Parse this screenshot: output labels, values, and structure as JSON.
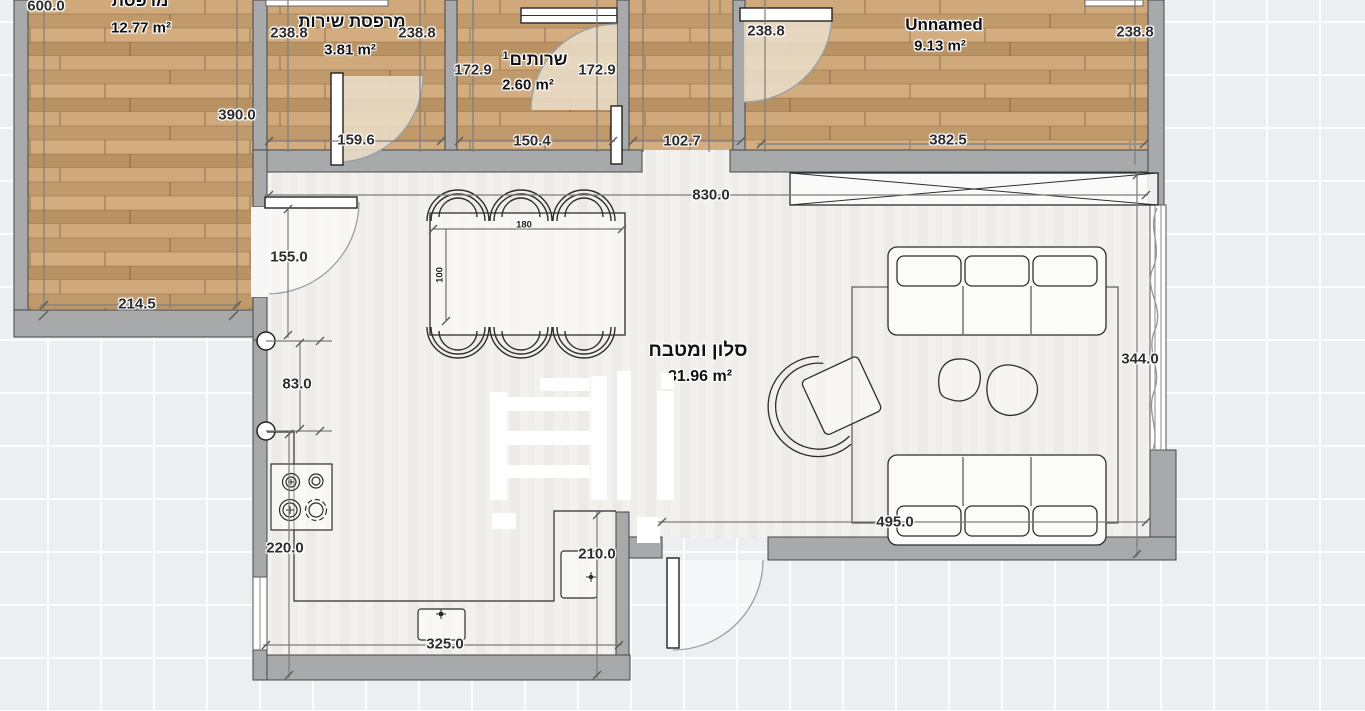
{
  "app": {
    "type": "floor-plan-editor-canvas"
  },
  "rooms": {
    "balcony": {
      "name": "מרפסת",
      "area": "12.77 m²"
    },
    "service_balcony": {
      "name": "מרפסת שירות",
      "area": "3.81 m²"
    },
    "bathroom": {
      "name": "שרותים",
      "index": "1",
      "area": "2.60 m²"
    },
    "unnamed": {
      "name": "Unnamed",
      "area": "9.13 m²"
    },
    "living_kitchen": {
      "name": "סלון ומטבח",
      "area": "31.96 m²"
    }
  },
  "dimensions": {
    "balcony_width_top": "600.0",
    "balcony_height": "390.0",
    "balcony_width_bottom": "214.5",
    "service_left": "238.8",
    "service_right": "238.8",
    "service_width": "159.6",
    "bathroom_left": "172.9",
    "bathroom_right": "172.9",
    "bathroom_width": "150.4",
    "hall_width": "102.7",
    "unnamed_left": "238.8",
    "unnamed_right": "238.8",
    "unnamed_width": "382.5",
    "living_width": "830.0",
    "balcony_door_offset": "155.0",
    "wall_segment": "83.0",
    "living_height": "344.0",
    "sofa_wall": "495.0",
    "kitchen_left": "220.0",
    "kitchen_island": "210.0",
    "kitchen_bottom": "325.0",
    "table_width": "180",
    "table_depth": "100"
  },
  "colors": {
    "wall": "#a8a9ab",
    "wood_floor": "#c79f70",
    "living_floor": "#f2f1ee",
    "canvas_bg": "#eceef2",
    "door_swing": "#e9ddc9"
  }
}
